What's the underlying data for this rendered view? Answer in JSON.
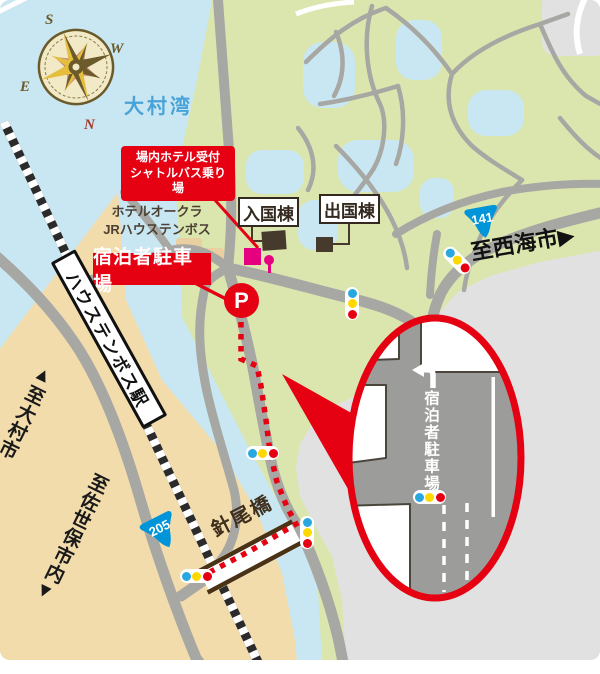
{
  "colors": {
    "water": "#C9E7F2",
    "land": "#F2DCAC",
    "park": "#DBE6AF",
    "paved": "#E1E1E1",
    "road": "#A7A7A3",
    "inset_road": "#9C9C9A",
    "red": "#E50012",
    "magenta": "#E4007F",
    "route_blue": "#0095D8",
    "tl_blue": "#29A8E0",
    "tl_yellow": "#FFD800",
    "tl_red": "#E50012",
    "dark_brown": "#463A2C",
    "label_brown": "#33291F",
    "rail": "#2B2B2B",
    "bay_text": "#4AA3D8",
    "bridge_brown": "#4A3215",
    "compass_gold": "#E5BE3D",
    "compass_olive": "#6B5A2A",
    "compass_rose": "#C4887B",
    "compass_cream": "#F2E9C6"
  },
  "map": {
    "bay_label": "大村湾",
    "hotel_label_line1": "ホテルオークラ",
    "hotel_label_line2": "JRハウステンボス",
    "shuttle_badge_line1": "場内ホテル受付",
    "shuttle_badge_line2": "シャトルバス乗り場",
    "entry_building_label": "入国棟",
    "exit_building_label": "出国棟",
    "guest_parking_label": "宿泊者駐車場",
    "parking_symbol": "P",
    "station_label": "ハウステンボス駅",
    "to_omura_label": "▲至大村市",
    "to_sasebo_label": "至佐世保市内▼",
    "to_saikai_label": "至西海市▶",
    "bridge_label": "針尾橋",
    "route_141": "141",
    "route_205": "205"
  },
  "inset": {
    "parking_label": "宿泊者駐車場"
  },
  "compass": {
    "north": "N",
    "south": "S",
    "east": "E",
    "west": "W"
  }
}
